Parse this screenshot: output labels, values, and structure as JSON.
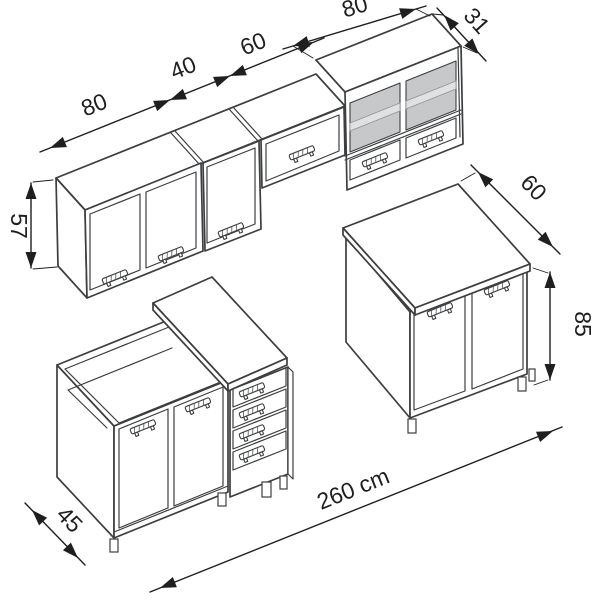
{
  "labels": {
    "wall_cabinet_a_width": "80",
    "wall_cabinet_b_width": "40",
    "wall_cabinet_c_width": "60",
    "wall_display_cabinet_width": "80",
    "wall_cabinet_depth": "31",
    "wall_cabinet_height": "57",
    "base_cabinet_depth": "60",
    "base_cabinet_height": "85",
    "corner_cabinet_depth": "45",
    "total_run_length": "260 cm"
  },
  "colors": {
    "line": "#3c3e40",
    "arrow_and_text": "#1f1f1f",
    "glass_pane": "#c6c8ca",
    "glass_shelf": "#e0e1e2",
    "background": "#ffffff"
  }
}
